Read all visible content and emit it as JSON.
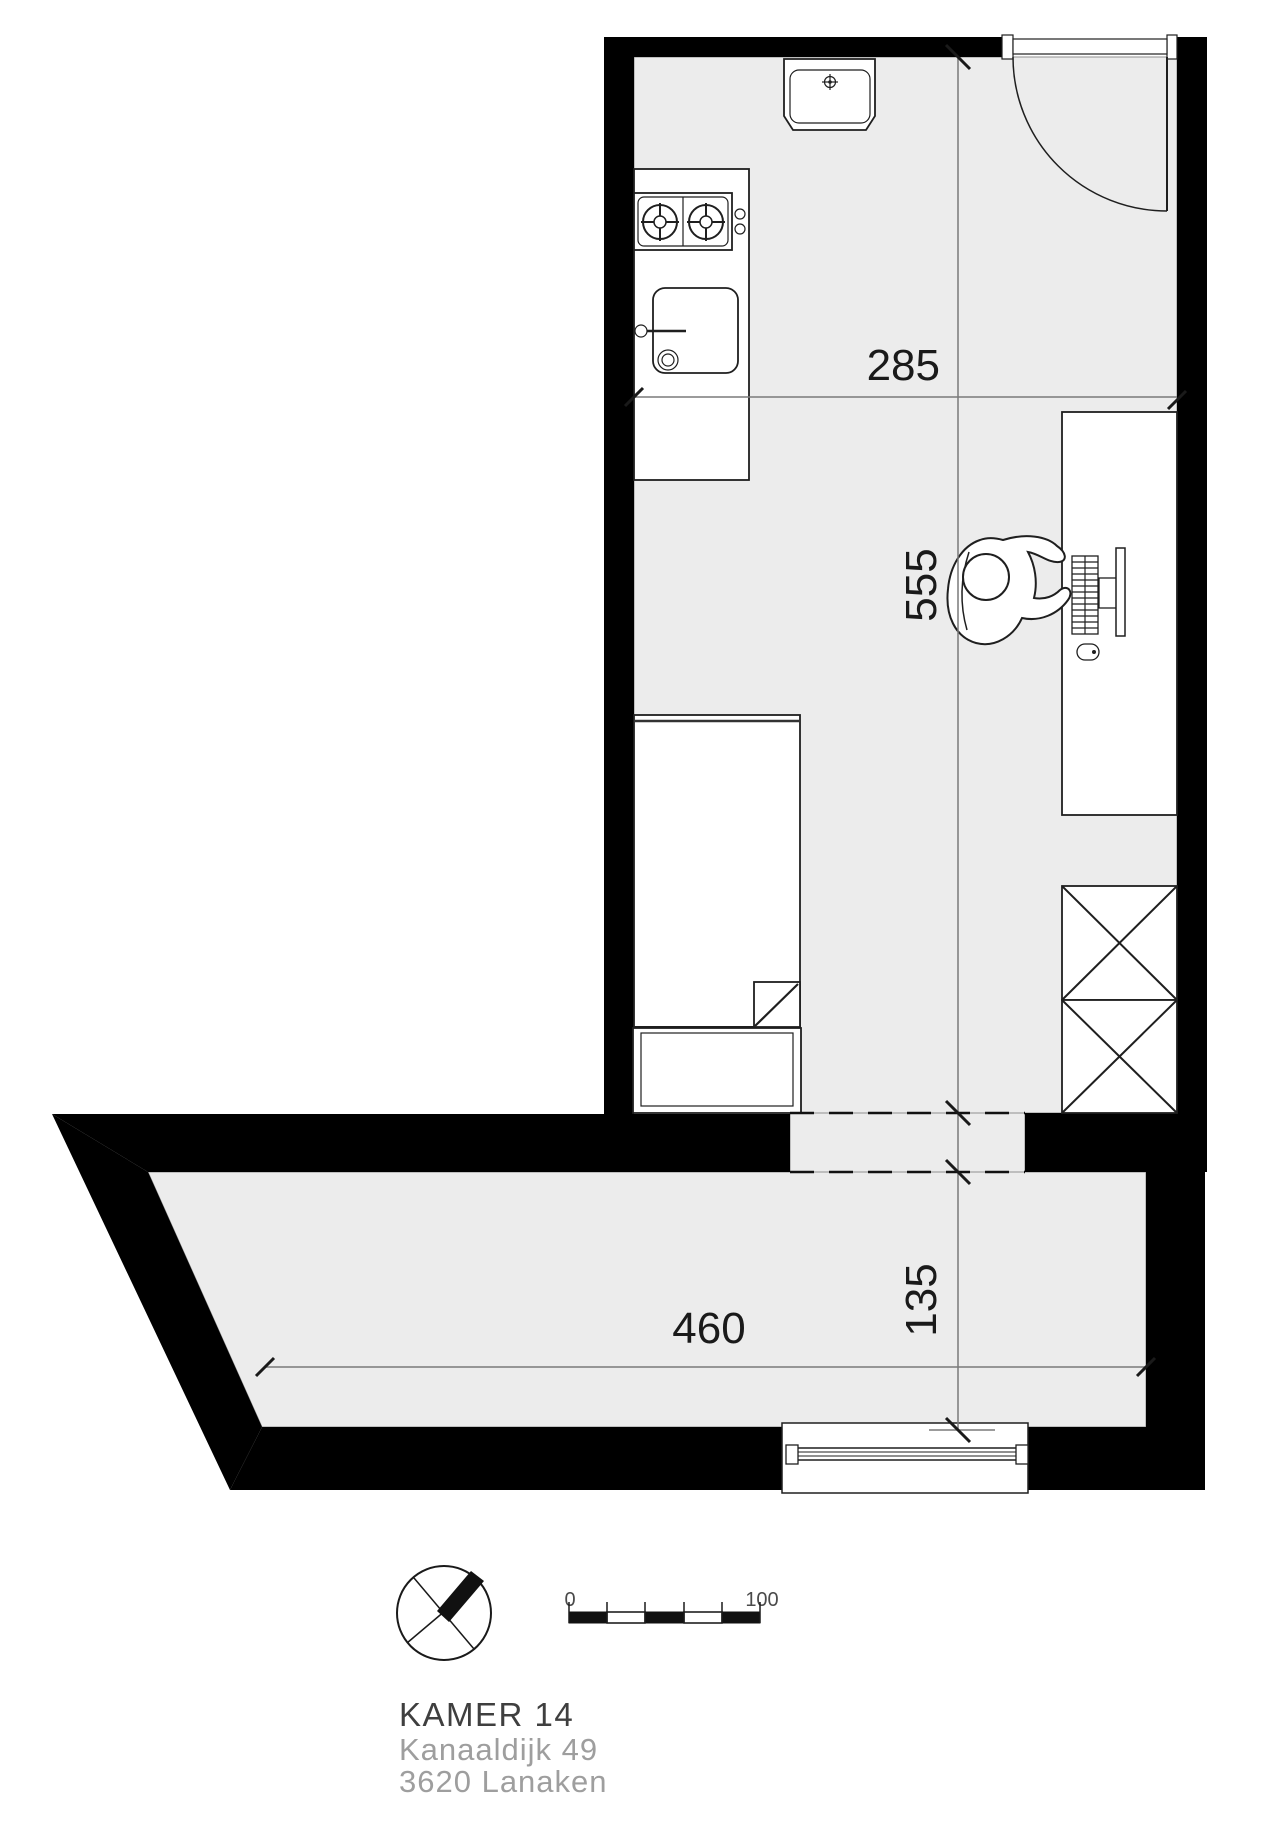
{
  "dimensions": {
    "top_room_width": "285",
    "top_room_length": "555",
    "bottom_room_width": "460",
    "bottom_room_depth": "135"
  },
  "scale_bar": {
    "min_label": "0",
    "max_label": "100"
  },
  "title_block": {
    "room_name": "KAMER 14",
    "address_street": "Kanaaldijk 49",
    "address_city": "3620 Lanaken"
  },
  "colors": {
    "wall": "#000000",
    "floor": "#ececec",
    "furniture_fill": "#ffffff",
    "outline": "#1f1f1f",
    "dimension_line": "#7a7a7a",
    "dimension_text": "#1a1a1a",
    "room_name_text": "#3f3f3f",
    "address_text": "#9e9e9e"
  },
  "icons": {
    "north_arrow": "circle-with-crossed-needles",
    "scale_bar": "alternating-black-white-ruler",
    "stove": "two-burner-hob",
    "kitchen_sink": "square-basin-with-faucet",
    "wash_basin": "wall-basin",
    "bed": "single-bed-with-folded-duvet",
    "desk": "desk-with-monitor-keyboard-mouse",
    "person": "seated-person-top-view",
    "wardrobe": "double-crossed-box",
    "door": "quarter-circle-swing",
    "window": "triple-line-glazing"
  }
}
